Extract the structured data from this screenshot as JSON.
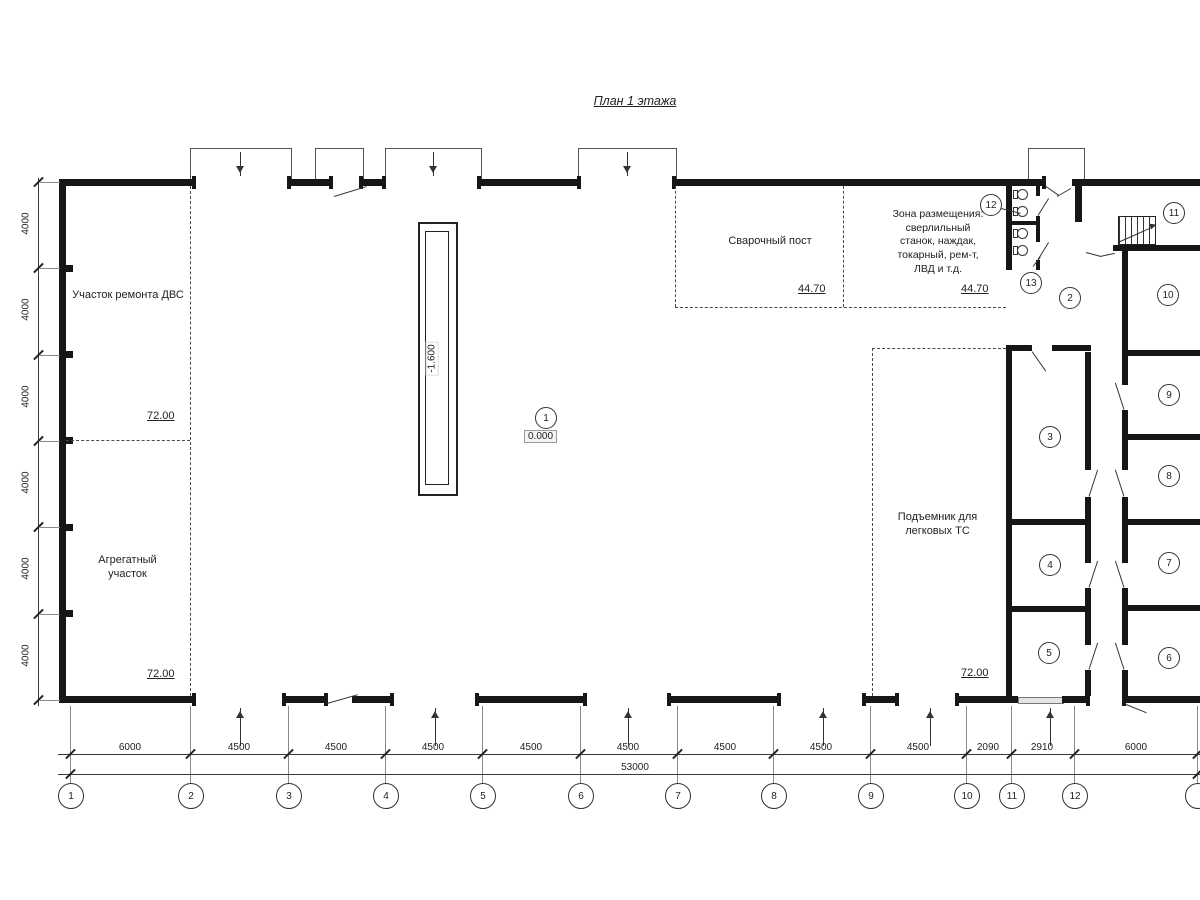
{
  "title": "План 1 этажа",
  "zones": {
    "engine_repair": "Участок ремонта ДВС",
    "aggregate": "Агрегатный участок",
    "welding": "Сварочный пост",
    "placement": "Зона размещения: сверлильный станок, наждак, токарный, рем-т, ЛВД и т.д.",
    "car_lift": "Подъемник для легковых ТС"
  },
  "elevations": {
    "left_mid": "72.00",
    "left_bottom": "72.00",
    "right_bottom": "72.00",
    "welding_zone": "44.70",
    "placement_zone": "44.70",
    "pit_depth": "-1.600",
    "floor_zero": "0.000"
  },
  "room_numbers": [
    "1",
    "2",
    "3",
    "4",
    "5",
    "6",
    "7",
    "8",
    "9",
    "10",
    "11",
    "12",
    "13"
  ],
  "axis_labels": [
    "1",
    "2",
    "3",
    "4",
    "5",
    "6",
    "7",
    "8",
    "9",
    "10",
    "11",
    "12"
  ],
  "dimensions": {
    "bottom": [
      "6000",
      "4500",
      "4500",
      "4500",
      "4500",
      "4500",
      "4500",
      "4500",
      "4500",
      "2090",
      "2910",
      "6000"
    ],
    "total": "53000",
    "left": [
      "4000",
      "4000",
      "4000",
      "4000",
      "4000",
      "4000"
    ]
  },
  "colors": {
    "line": "#1a1a1a",
    "wall": "#161616",
    "dash": "#4a4a4a"
  }
}
